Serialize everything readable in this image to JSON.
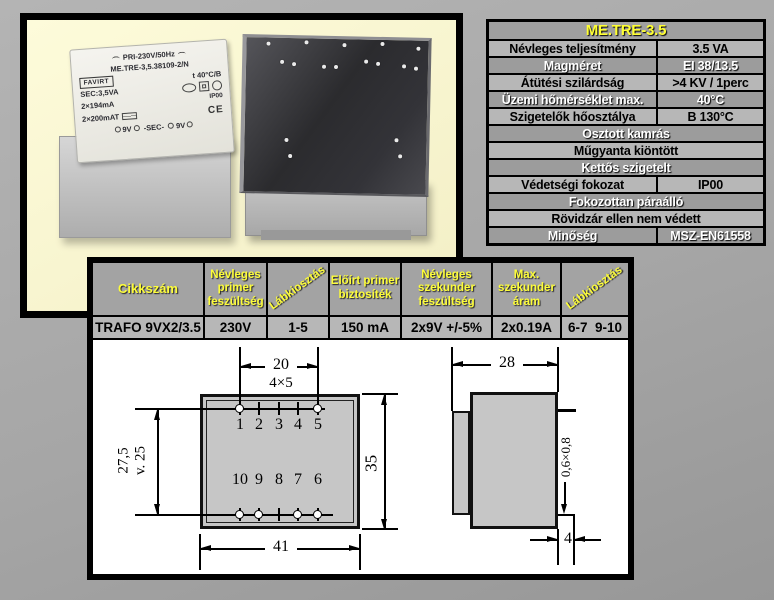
{
  "spec_table": {
    "title": "ME.TRE-3.5",
    "rows": [
      {
        "label": "Névleges teljesítmény",
        "value": "3.5 VA"
      },
      {
        "label": "Magméret",
        "value": "EI 38/13.5"
      },
      {
        "label": "Átütési szilárdság",
        "value": ">4 KV / 1perc"
      },
      {
        "label": "Üzemi hőmérséklet max.",
        "value": "40°C"
      },
      {
        "label": "Szigetelők hőosztálya",
        "value": "B 130°C"
      },
      {
        "label": "Osztott kamrás"
      },
      {
        "label": "Műgyanta kiöntött"
      },
      {
        "label": "Kettős szigetelt"
      },
      {
        "label": "Védetségi fokozat",
        "value": "IP00"
      },
      {
        "label": "Fokozottan páraálló"
      },
      {
        "label": "Rövidzár ellen nem védett"
      },
      {
        "label": "Minőség",
        "value": "MSZ-EN61558"
      }
    ]
  },
  "order_table": {
    "headers": [
      "Cikkszám",
      "Névleges primer feszültség",
      "Lábkiosztás",
      "Előírt primer biztosíték",
      "Névleges szekunder feszültség",
      "Max. szekunder áram",
      "Lábkiosztás"
    ],
    "row": [
      "TRAFO 9VX2/3.5",
      "230V",
      "1-5",
      "150 mA",
      "2x9V +/-5%",
      "2x0.19A",
      "6-7  9-10"
    ]
  },
  "drawing": {
    "bottom_view": {
      "pin_span_label": "20",
      "pin_pitch_label": "4×5",
      "pins_top": [
        "1",
        "2",
        "3",
        "4",
        "5"
      ],
      "pins_bottom": [
        "10",
        "9",
        "8",
        "7",
        "6"
      ],
      "row_spacing_line1": "27,5",
      "row_spacing_line2": "v. 25",
      "height_label": "35",
      "width_label": "41"
    },
    "side_view": {
      "depth_label": "28",
      "pin_section_label": "0,6×0,8",
      "pin_length_label": "4"
    }
  },
  "photo_label": {
    "line1": "PRI-230V/50Hz",
    "line2": "ME.TRE-3,5.38109-2/N",
    "brand": "FAVIRT",
    "temp_class": "t 40°C/B",
    "sec_power": "SEC:3,5VA",
    "sec_current": "2×194mA",
    "fuse_rating": "2×200mAT",
    "ip": "IP00",
    "ce": "CE",
    "pinout_left": "9V",
    "pinout_mid": "-SEC-",
    "pinout_right": "9V"
  },
  "colors": {
    "accent_yellow": "#ffff33",
    "photo_bg": "#fbf8d2",
    "row_light": "#b7b7b7",
    "row_dark": "#9c9c9c",
    "page_bg": "#a9a9a9",
    "drawing_bg": "#ffffff"
  }
}
